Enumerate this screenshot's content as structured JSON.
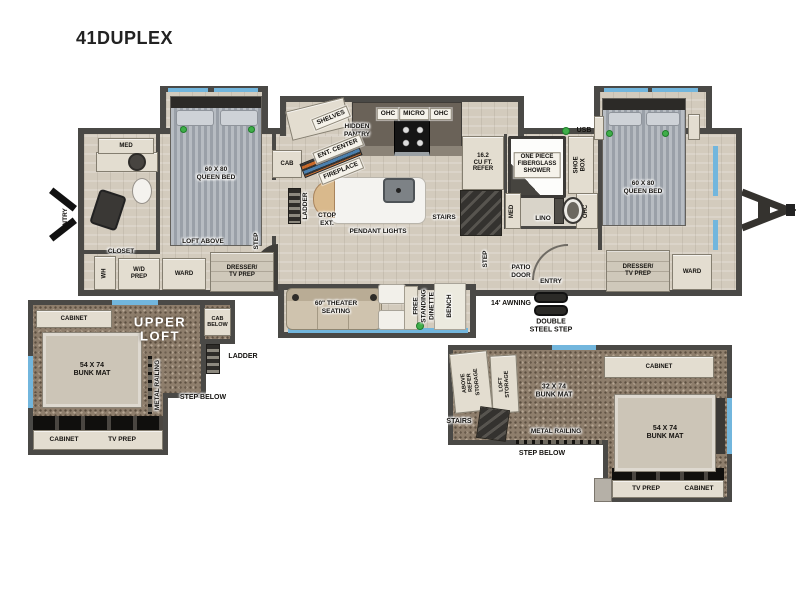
{
  "title": "41DUPLEX",
  "colors": {
    "wall": "#4a4946",
    "wood_floor": "#d3cbbd",
    "loft_carpet": "#8e7e6c",
    "accent_blue": "#72b6dd",
    "indicator_green": "#3fae49",
    "label_bg": "#f5f2ea"
  },
  "main": {
    "bedroom_front": {
      "bed": "60 X 80\nQUEEN BED",
      "med": "MED",
      "loft_above": "LOFT ABOVE",
      "step": "STEP",
      "cab": "CAB",
      "ward": "WARD",
      "dresser": "DRESSER/\nTV PREP",
      "closet": "CLOSET",
      "water_heater": "WH",
      "wd_prep": "W/D\nPREP",
      "entry": "ENTRY"
    },
    "kitchen": {
      "shelves": "SHELVES",
      "hidden_pantry": "HIDDEN\nPANTRY",
      "ent_center": "ENT. CENTER",
      "fireplace": "FIREPLACE",
      "ohc_left": "OHC",
      "micro": "MICRO",
      "ohc_right": "OHC",
      "ladder": "LADDER",
      "ctop_ext": "CTOP\nEXT.",
      "pendant_lights": "PENDANT LIGHTS",
      "stairs": "STAIRS",
      "refer": "16.2\nCU FT.\nREFER"
    },
    "bath": {
      "shower": "ONE PIECE\nFIBERGLASS\nSHOWER",
      "shoe_box": "SHOE\nBOX",
      "usb": "USB",
      "med": "MED",
      "lino": "LINO",
      "ohc": "OHC"
    },
    "living": {
      "theater": "60\" THEATER\nSEATING",
      "dinette": "FREE\nSTANDING\nDINETTE",
      "bench": "BENCH",
      "step": "STEP",
      "patio_door": "PATIO\nDOOR",
      "entry": "ENTRY",
      "awning": "14' AWNING",
      "double_steel_step": "DOUBLE\nSTEEL STEP"
    },
    "bedroom_rear": {
      "bed": "60 X 80\nQUEEN BED",
      "dresser": "DRESSER/\nTV PREP",
      "ward": "WARD"
    }
  },
  "loft_left": {
    "title": "UPPER\nLOFT",
    "cabinet_top": "CABINET",
    "cab_below": "CAB\nBELOW",
    "ladder": "LADDER",
    "bunk": "54 X 74\nBUNK MAT",
    "metal_railing": "METAL RAILING",
    "step_below": "STEP BELOW",
    "cabinet_bottom": "CABINET",
    "tv_prep": "TV PREP"
  },
  "loft_right": {
    "above_refer_storage": "ABOVE\nREFER\nSTORAGE",
    "loft_storage": "LOFT\nSTORAGE",
    "stairs": "STAIRS",
    "bunk_small": "32 X 74\nBUNK MAT",
    "metal_railing": "METAL RAILING",
    "step_below": "STEP BELOW",
    "cabinet_top": "CABINET",
    "bunk_large": "54 X 74\nBUNK MAT",
    "tv_prep": "TV PREP",
    "cabinet_bottom": "CABINET"
  }
}
